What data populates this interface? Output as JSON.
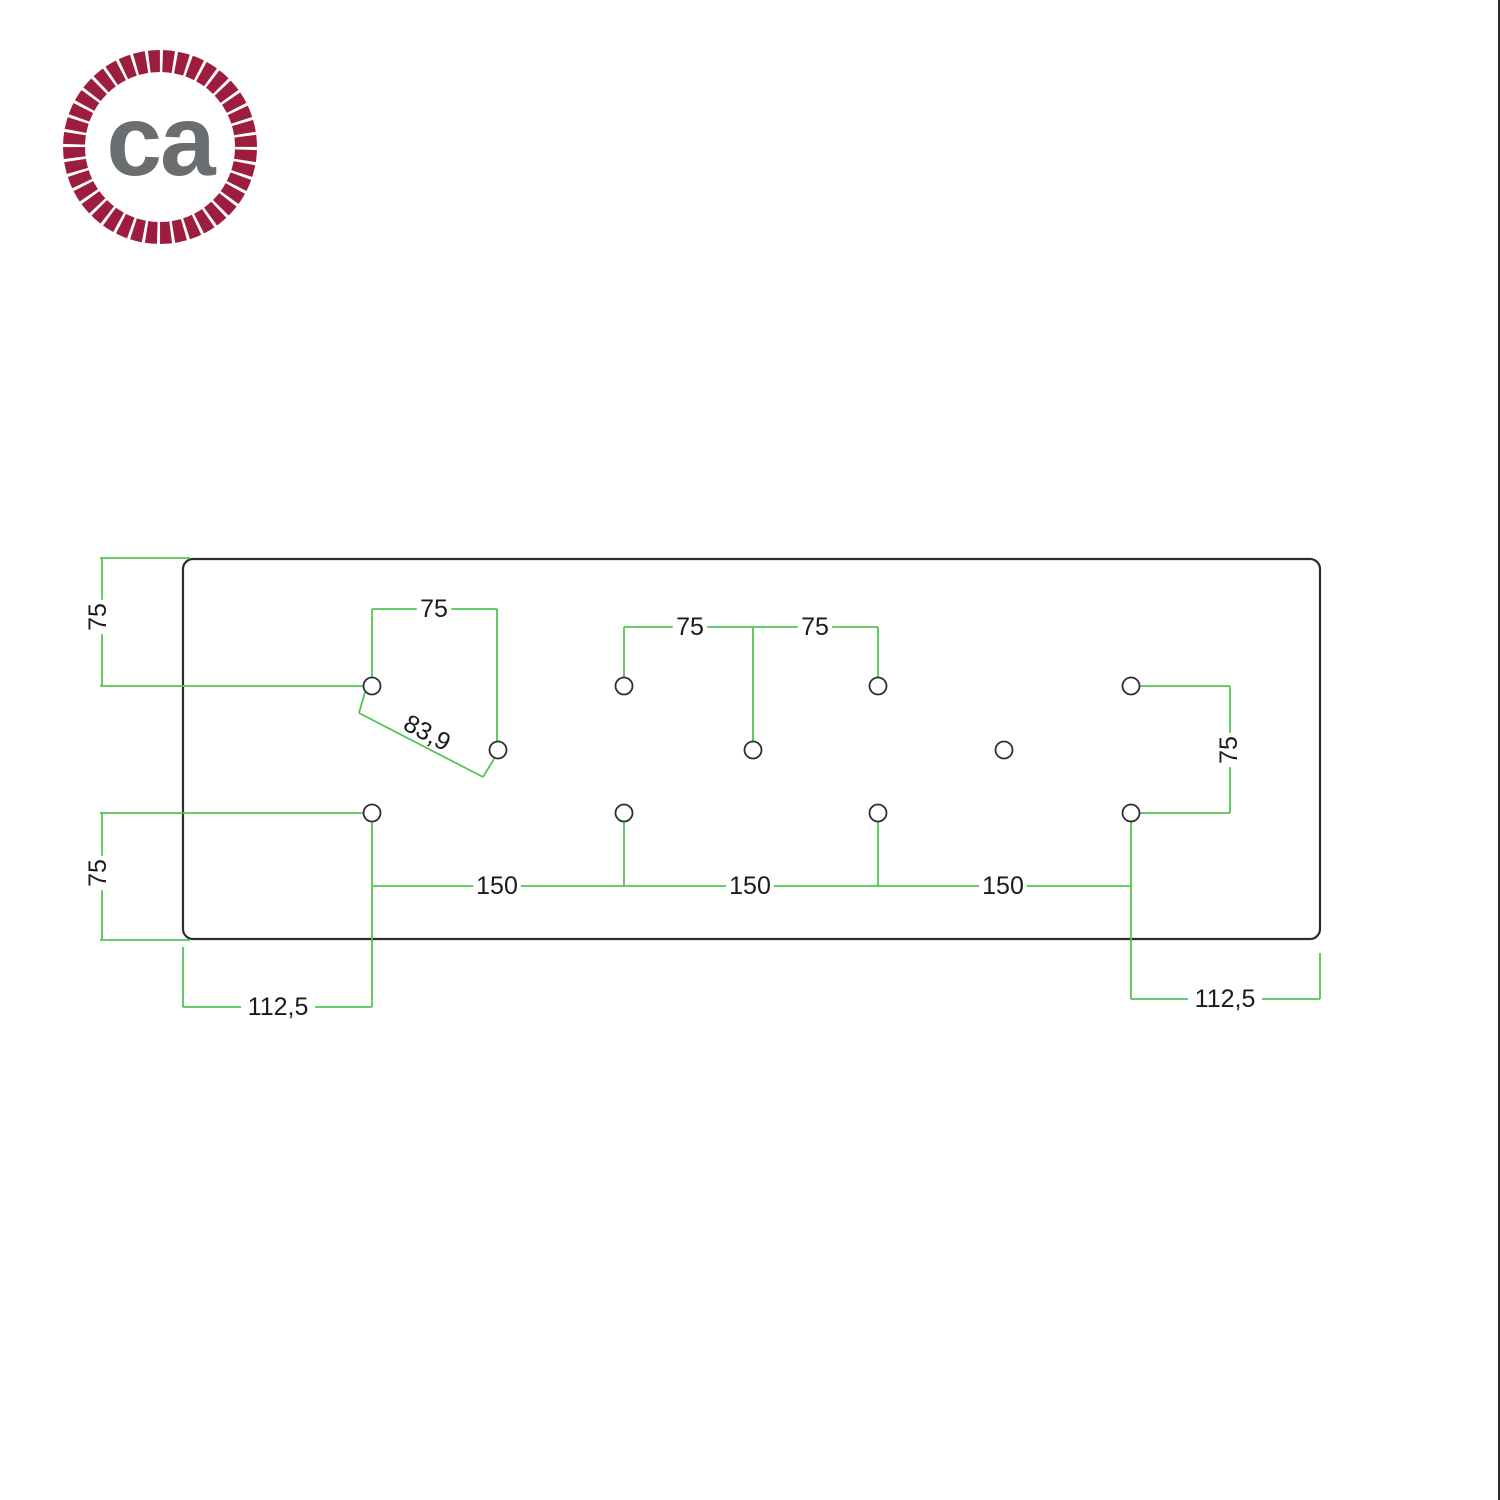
{
  "canvas": {
    "width": 1500,
    "height": 1500,
    "background": "#ffffff",
    "right_border_color": "#2e2e2e"
  },
  "logo": {
    "text": "ca",
    "ring_color": "#9d1d3f",
    "twist_color": "#ffffff",
    "text_color": "#6b6e70"
  },
  "drawing": {
    "units": "mm",
    "colors": {
      "outline": "#2d2d2d",
      "dimension": "#53c553",
      "text": "#1b1b1b",
      "hole_fill": "#ffffff"
    },
    "plate": {
      "x": 183,
      "y": 559,
      "width": 1137,
      "height": 380,
      "corner_radius": 10
    },
    "holes": {
      "radius": 8.5,
      "centers": [
        [
          372,
          686
        ],
        [
          624,
          686
        ],
        [
          878,
          686
        ],
        [
          1131,
          686
        ],
        [
          498,
          750
        ],
        [
          753,
          750
        ],
        [
          1004,
          750
        ],
        [
          372,
          813
        ],
        [
          624,
          813
        ],
        [
          878,
          813
        ],
        [
          1131,
          813
        ]
      ]
    },
    "dimension_lines": [
      [
        100,
        558,
        190,
        558
      ],
      [
        102,
        558,
        102,
        686
      ],
      [
        100,
        686,
        364,
        686
      ],
      [
        372,
        609,
        497,
        609
      ],
      [
        372,
        609,
        372,
        678
      ],
      [
        497,
        609,
        497,
        742
      ],
      [
        365,
        692,
        359,
        713
      ],
      [
        359,
        713,
        483,
        777
      ],
      [
        483,
        777,
        494,
        759
      ],
      [
        624,
        627,
        878,
        627
      ],
      [
        624,
        627,
        624,
        678
      ],
      [
        878,
        627,
        878,
        678
      ],
      [
        753,
        627,
        753,
        742
      ],
      [
        1140,
        686,
        1230,
        686
      ],
      [
        1230,
        686,
        1230,
        813
      ],
      [
        1140,
        813,
        1230,
        813
      ],
      [
        100,
        813,
        364,
        813
      ],
      [
        102,
        813,
        102,
        940
      ],
      [
        100,
        940,
        190,
        940
      ],
      [
        372,
        821,
        372,
        1007
      ],
      [
        624,
        821,
        624,
        886
      ],
      [
        878,
        821,
        878,
        886
      ],
      [
        1131,
        821,
        1131,
        999
      ],
      [
        372,
        886,
        1131,
        886
      ],
      [
        183,
        947,
        183,
        1007
      ],
      [
        183,
        1007,
        372,
        1007
      ],
      [
        1320,
        953,
        1320,
        999
      ],
      [
        1131,
        999,
        1320,
        999
      ]
    ],
    "labels": [
      {
        "text": "75",
        "x": 98,
        "y": 617,
        "rot": -90
      },
      {
        "text": "75",
        "x": 434,
        "y": 609,
        "rot": 0
      },
      {
        "text": "83,9",
        "x": 427,
        "y": 733,
        "rot": 28,
        "bg": false
      },
      {
        "text": "75",
        "x": 690,
        "y": 627,
        "rot": 0
      },
      {
        "text": "75",
        "x": 815,
        "y": 627,
        "rot": 0
      },
      {
        "text": "75",
        "x": 1229,
        "y": 750,
        "rot": -90
      },
      {
        "text": "75",
        "x": 98,
        "y": 873,
        "rot": -90
      },
      {
        "text": "150",
        "x": 497,
        "y": 886,
        "rot": 0
      },
      {
        "text": "150",
        "x": 750,
        "y": 886,
        "rot": 0
      },
      {
        "text": "150",
        "x": 1003,
        "y": 886,
        "rot": 0
      },
      {
        "text": "112,5",
        "x": 278,
        "y": 1007,
        "rot": 0
      },
      {
        "text": "112,5",
        "x": 1225,
        "y": 999,
        "rot": 0
      }
    ]
  }
}
